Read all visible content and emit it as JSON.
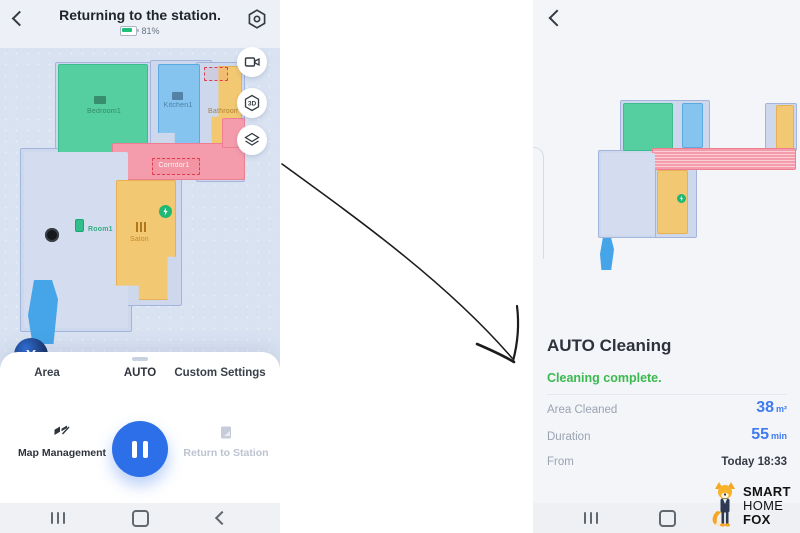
{
  "left_screen": {
    "header": {
      "title": "Returning to the station.",
      "battery": "81%"
    },
    "map": {
      "current_map": "Current map: Map1",
      "rooms": {
        "bedroom": "Bedroom1",
        "kitchen": "Kitchen1",
        "bathroom": "Bathroom",
        "corridor": "Corridor1",
        "room1": "Room1",
        "salon": "Salon"
      },
      "avatar_letter": "Y",
      "threed_label": "3D"
    },
    "tabs": {
      "area": "Area",
      "auto": "AUTO",
      "custom": "Custom Settings"
    },
    "actions": {
      "map_management": "Map Management",
      "return_to_station": "Return to Station"
    }
  },
  "right_screen": {
    "title": "AUTO Cleaning",
    "status": "Cleaning complete.",
    "stats": [
      {
        "label": "Area Cleaned",
        "value": "38",
        "unit": "m²"
      },
      {
        "label": "Duration",
        "value": "55",
        "unit": "min"
      },
      {
        "label": "From",
        "value": "Today 18:33",
        "unit": ""
      }
    ]
  },
  "watermark": {
    "line1": "SMART",
    "line2": "HOME",
    "line3": "FOX"
  },
  "colors": {
    "accent_blue": "#2d6fe8",
    "value_blue": "#3f7bf0",
    "status_green": "#3cb94e",
    "battery_green": "#1fbf7a",
    "room_green": "#55cfa0",
    "room_blue": "#85c4ee",
    "room_orange": "#f3c873",
    "room_pink": "#f49cab"
  }
}
